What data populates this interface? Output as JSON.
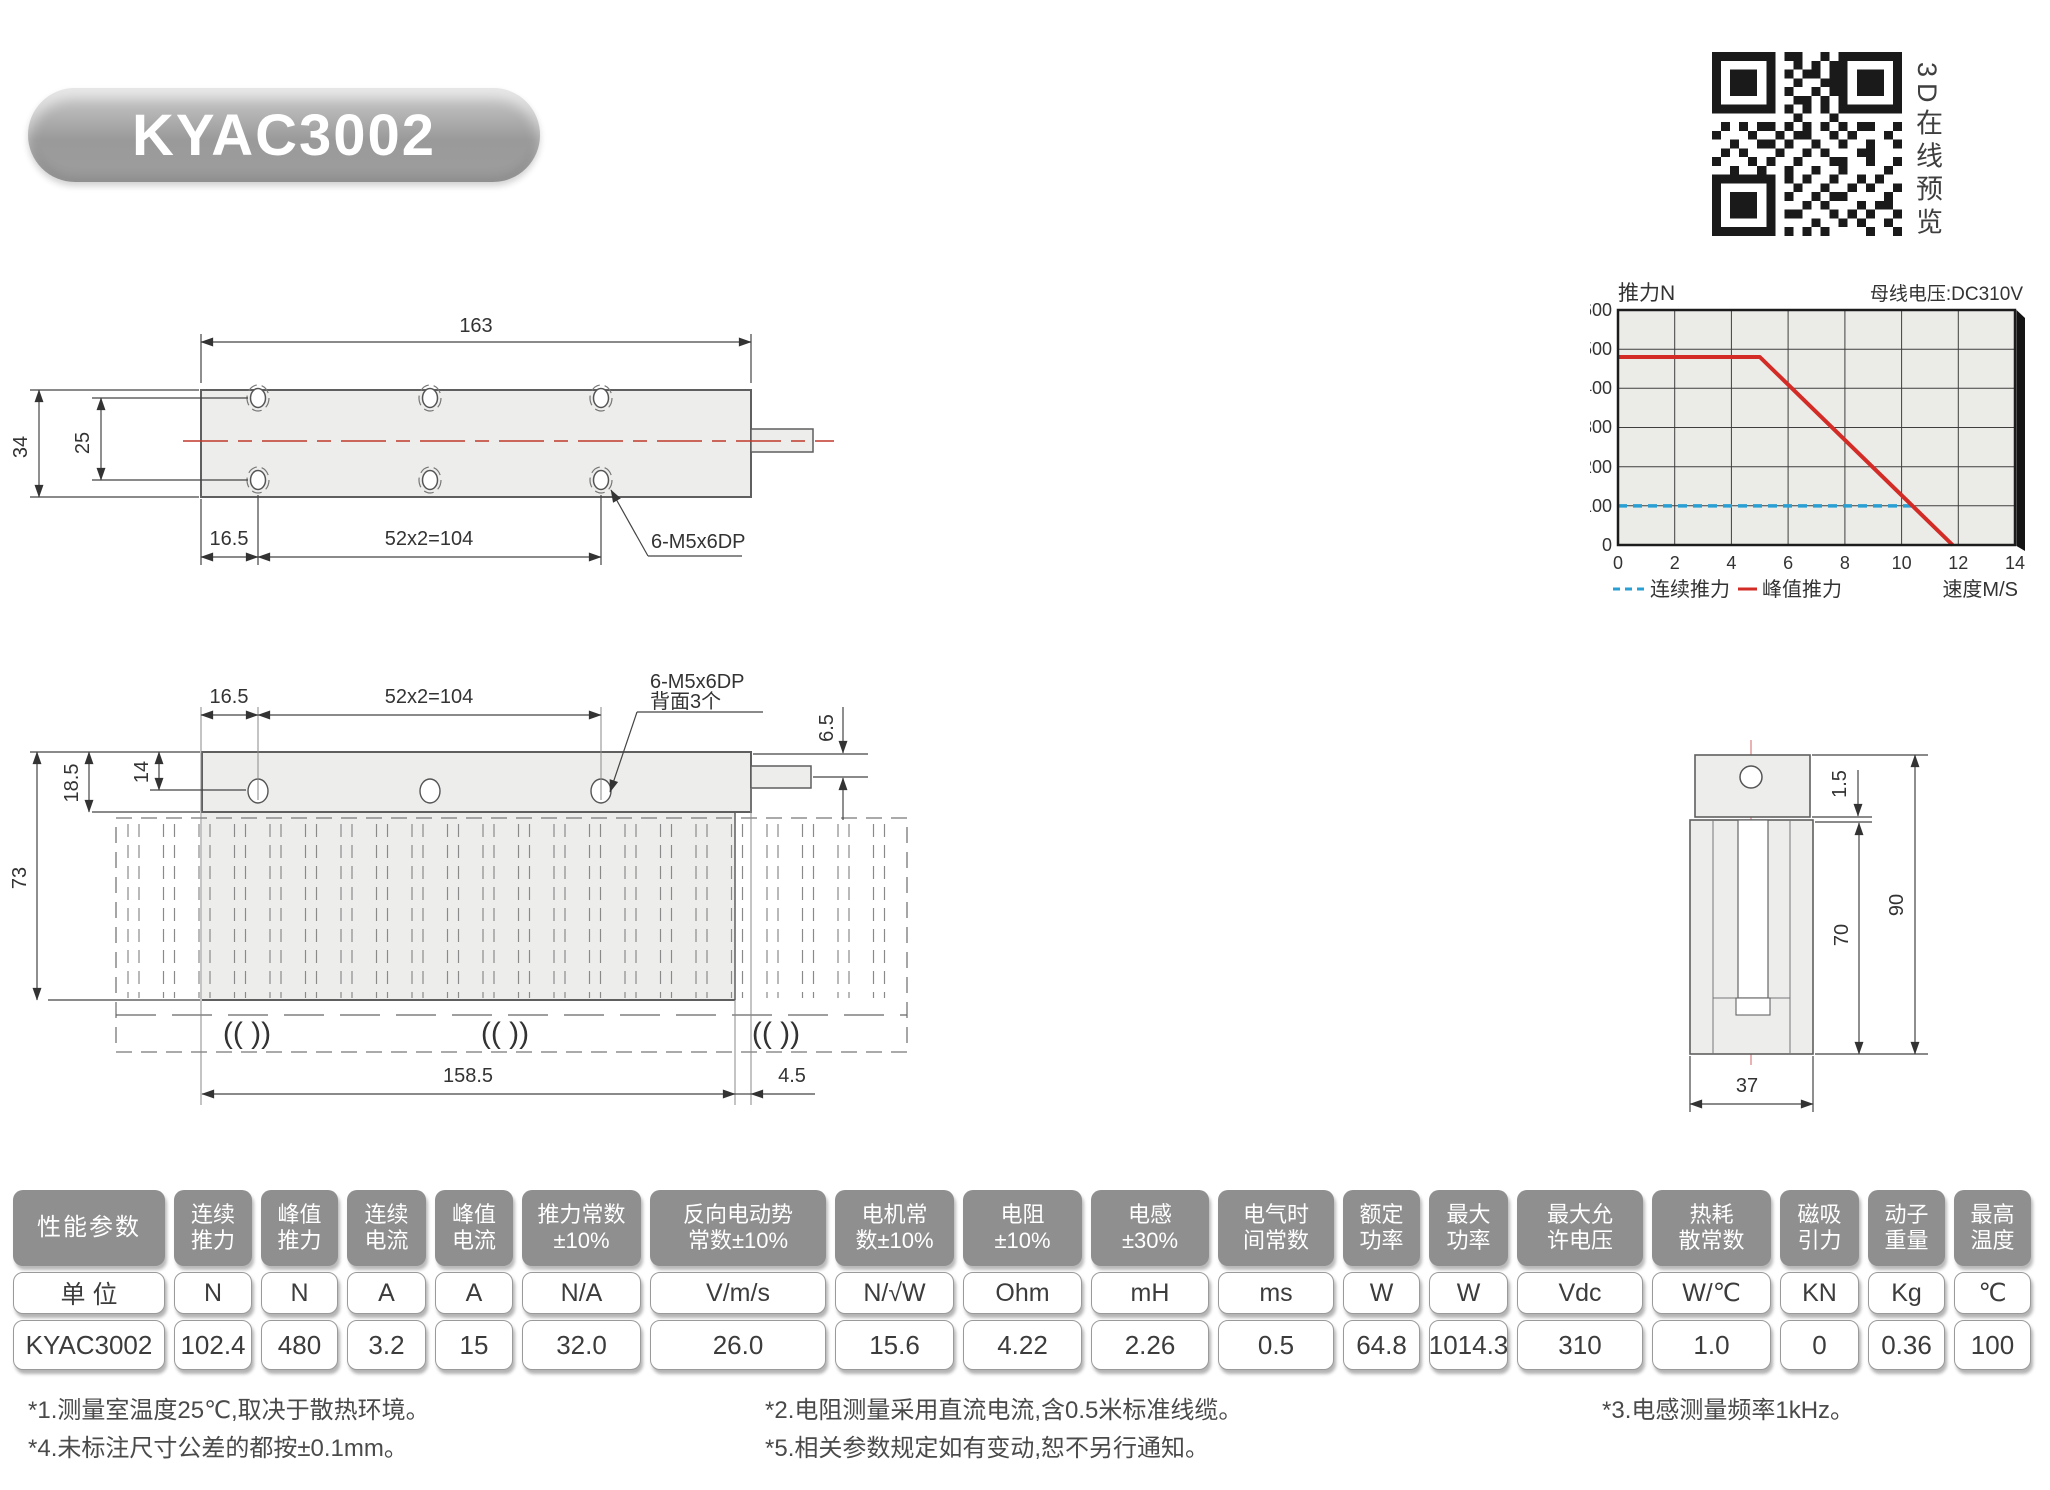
{
  "title_badge": {
    "label": "KYAC3002"
  },
  "qr": {
    "caption": "3D在线预览"
  },
  "chart_data": {
    "type": "line",
    "title": "推力N",
    "bus_voltage_note": "母线电压:DC310V",
    "xlabel": "速度M/S",
    "xlim": [
      0,
      14
    ],
    "ylim": [
      0,
      600
    ],
    "x_ticks": [
      0,
      2,
      4,
      6,
      8,
      10,
      12,
      14
    ],
    "y_ticks": [
      0,
      100,
      200,
      300,
      400,
      500,
      600
    ],
    "grid": true,
    "legend_position": "bottom",
    "plot_bg": "#ebebe8",
    "series": [
      {
        "name": "连续推力",
        "style": "dashed",
        "color": "#2a9fd4",
        "points": [
          [
            0,
            100
          ],
          [
            10.35,
            100
          ]
        ]
      },
      {
        "name": "峰值推力",
        "style": "solid",
        "color": "#d32b26",
        "points": [
          [
            0,
            480
          ],
          [
            5,
            480
          ],
          [
            11.8,
            0
          ]
        ]
      }
    ]
  },
  "drawings": {
    "top_view": {
      "length": "163",
      "height": "34",
      "hole_span": "25",
      "offset": "16.5",
      "pitch": "52x2=104",
      "hole_note": "6-M5x6DP"
    },
    "side_view": {
      "offset": "16.5",
      "pitch": "52x2=104",
      "hole_note_line1": "6-M5x6DP",
      "hole_note_line2": "背面3个",
      "cable_offset": "6.5",
      "body_height": "18.5",
      "hole_depth": "14",
      "total_height": "73",
      "stator_length": "158.5",
      "end_gap": "4.5",
      "roller_symbol": "(( ))"
    },
    "end_view": {
      "air_gap": "1.5",
      "total_height": "90",
      "slot_depth": "70",
      "width": "37"
    }
  },
  "table": {
    "headers": [
      "性能参数",
      "连续\n推力",
      "峰值\n推力",
      "连续\n电流",
      "峰值\n电流",
      "推力常数\n±10%",
      "反向电动势\n常数±10%",
      "电机常\n数±10%",
      "电阻\n±10%",
      "电感\n±30%",
      "电气时\n间常数",
      "额定\n功率",
      "最大\n功率",
      "最大允\n许电压",
      "热耗\n散常数",
      "磁吸\n引力",
      "动子\n重量",
      "最高\n温度"
    ],
    "units": [
      "单 位",
      "N",
      "N",
      "A",
      "A",
      "N/A",
      "V/m/s",
      "N/√W",
      "Ohm",
      "mH",
      "ms",
      "W",
      "W",
      "Vdc",
      "W/℃",
      "KN",
      "Kg",
      "℃"
    ],
    "values": [
      "KYAC3002",
      "102.4",
      "480",
      "3.2",
      "15",
      "32.0",
      "26.0",
      "15.6",
      "4.22",
      "2.26",
      "0.5",
      "64.8",
      "1014.3",
      "310",
      "1.0",
      "0",
      "0.36",
      "100"
    ]
  },
  "footnotes": {
    "col1": [
      "*1.测量室温度25℃,取决于散热环境。",
      "*4.未标注尺寸公差的都按±0.1mm。"
    ],
    "col2": [
      "*2.电阻测量采用直流电流,含0.5米标准线缆。",
      "*5.相关参数规定如有变动,恕不另行通知。"
    ],
    "col3": [
      "*3.电感测量频率1kHz。"
    ]
  }
}
